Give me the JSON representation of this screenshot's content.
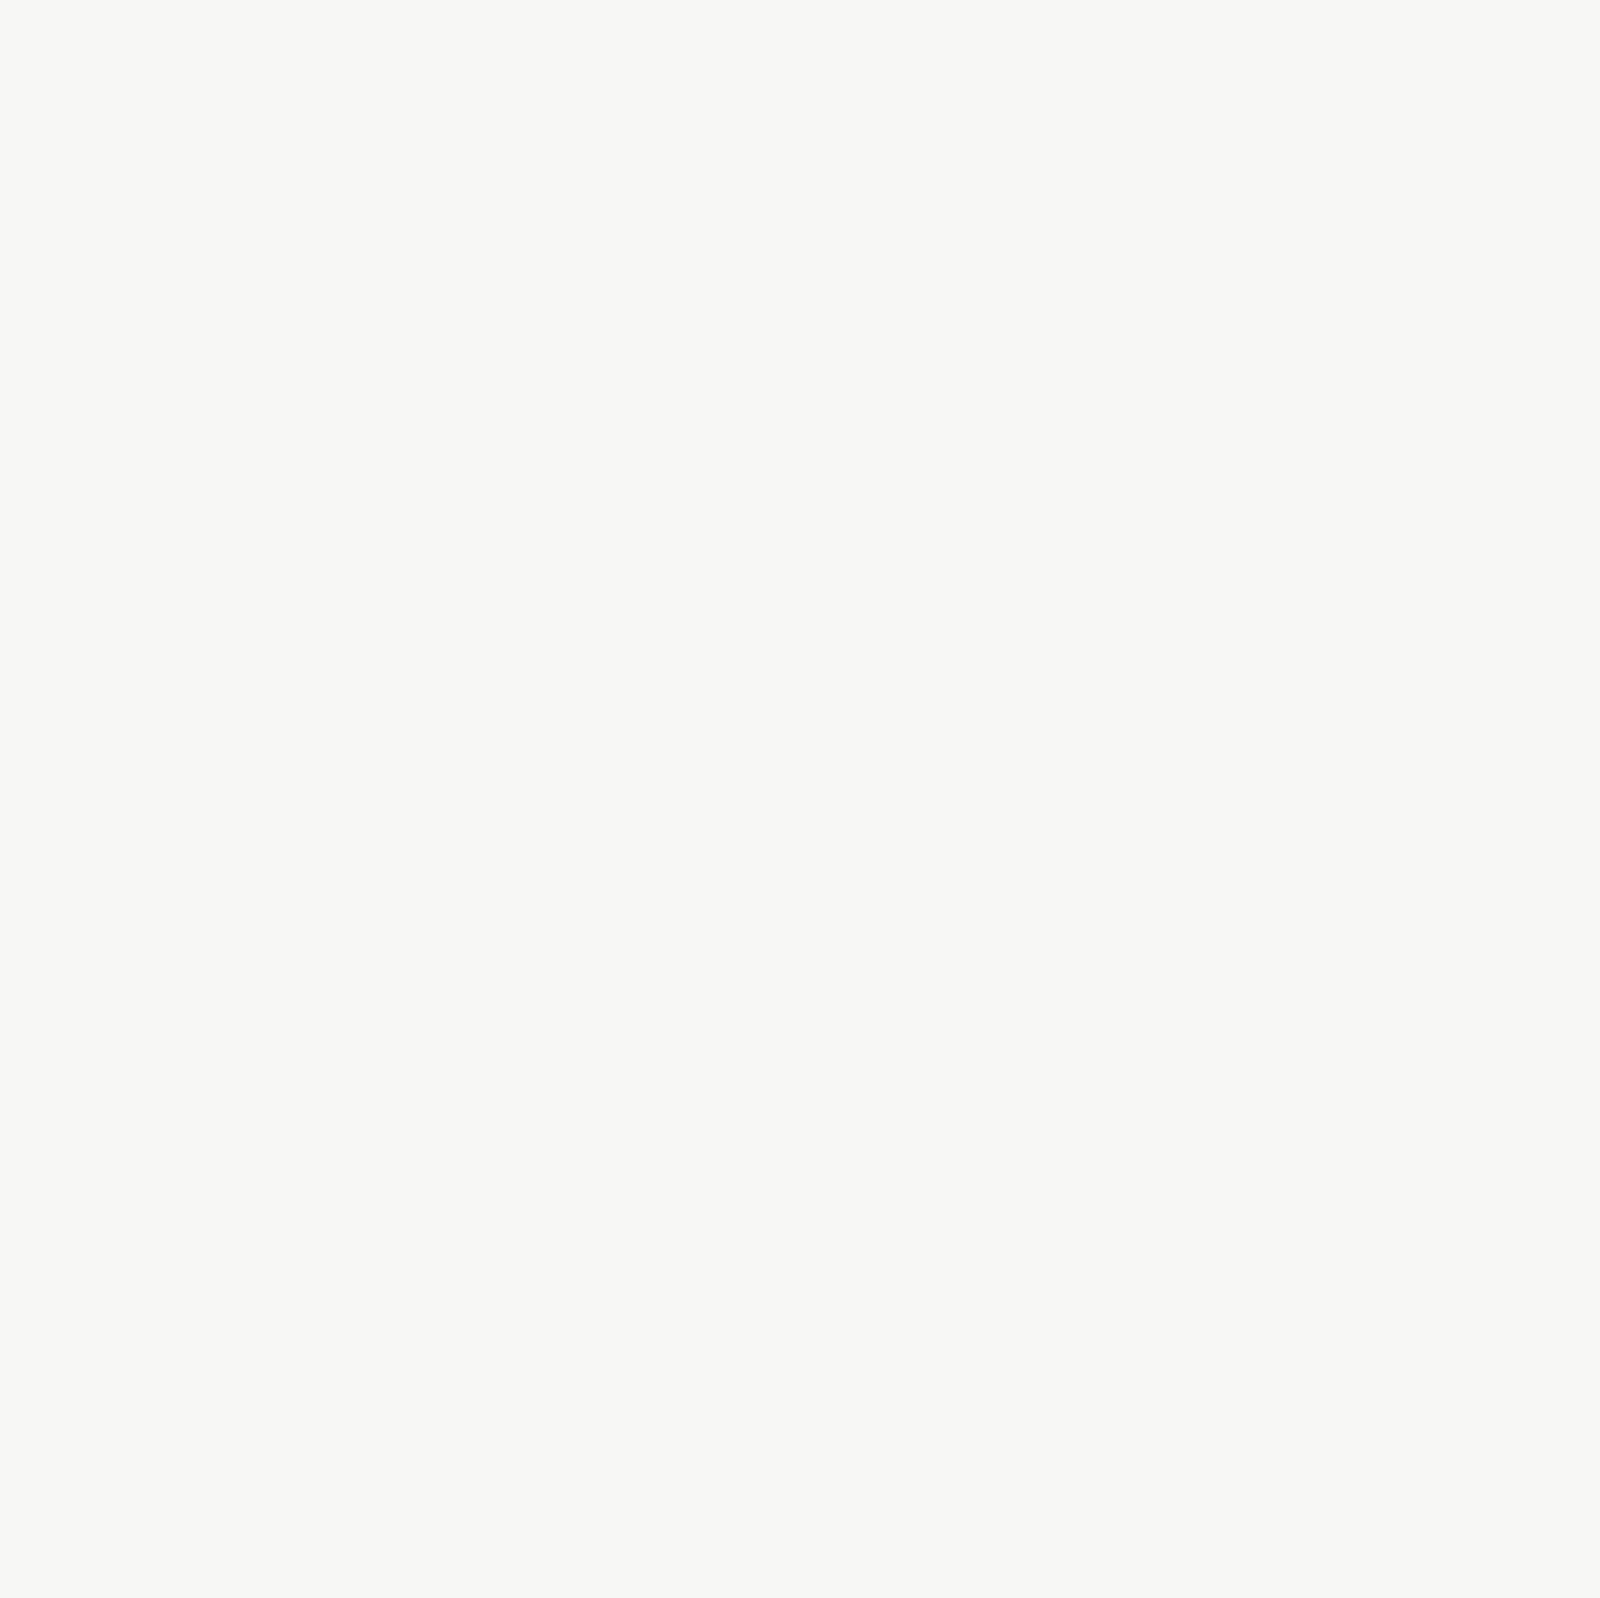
{
  "map": {
    "title_area": "Les Jardins Neppert - plan masse",
    "lots": {
      "n4": {
        "title": "Lot N4",
        "subtitle": "LOT N4 - 12 LOGTS",
        "note_line1": "21 pl. par nx",
        "note_line2": "84 places sur 4 nx"
      },
      "n3": {
        "title": "Lot N3",
        "subtitle": "LOT N3 - 9 LOGTS",
        "parking": "12 pl."
      },
      "ch1": {
        "title": "Lot Ch1",
        "subtitle": "LOT CH1 - 8 LOGTS"
      },
      "ch2": {
        "title": "Lot Ch2",
        "subtitle": "LOT CH2 - 39 LOGTS",
        "parking": "62 pl."
      },
      "n7": {
        "title": "Lot N7",
        "subtitle": "LOT N7 - 55 LOGTS"
      },
      "n8": {
        "title": "Lot N8",
        "subtitle": "LOT N8 - 46 LOGTS",
        "parking_left": "29 pl.",
        "parking_right": "18 pl."
      },
      "ch4": {
        "title": "Lot Ch4",
        "subtitle": "LOT CH4 - 34 LOGTS",
        "parking_top": "15 pl.",
        "parking_vertical": "20 pl.",
        "parking_question": "26 pl.?"
      },
      "n9": {
        "title": "Lot N9",
        "subtitle": "LOT N9 - 45 LOGTS",
        "parking": "25 pl.",
        "note": "54 places sur 2 nx"
      },
      "ch_truncated": "Ch"
    },
    "zones": {
      "n2": "N2",
      "n5": "N5",
      "n6": "N6"
    },
    "heights": {
      "r3c": "R+3+c",
      "r2c_a": "R+2+c",
      "r2c_b": "R+2+c",
      "r2c_c": "R+2+c",
      "r4": "R+4",
      "r3": "R+3",
      "r1": "R+1",
      "rdcc": "RDC+c"
    },
    "streets": {
      "rue_des_roses": "Rue des Roses",
      "passage_des_roses": "Passage des Roses",
      "rue_neppert_west": "Rue Neppert",
      "rue_neppert_east": "Rue Neppert",
      "rue_de_la_branche": "Rue de la Branche",
      "rue_des_chaudronniers": "Rue des Chaudronniers",
      "rue_des_menuisiers": "Rue des Menuisiers",
      "rue_des_charpentiers_north": "Rue des Charpentiers",
      "impasse_des_charpentiers": "Impasse des Charpentiers",
      "rue_des_charpentiers_south": "Rue des Charpentiers",
      "rue_de_lyser": "Rue de l'Yser",
      "passage_des_vergers": "Passage des Vergers",
      "rue_des_vergers": "Rue des Vergers",
      "rue_des_pyrenees": "Rue des Pyrénées",
      "rue_d_ensisheim": "Rue d'Ensisheim",
      "rue_d_illzach": "Rue d' Illzach",
      "rue_du_capitaine_dreyfus": "Rue du Capitaine Dreyfus",
      "les_mesanges": "Les Mésanges"
    },
    "places": {
      "ecole": "ÉCOLE J. DE LOISY",
      "eglise_line1": "ÉGLISE",
      "eglise_line2": "BONNE NOUVELLE",
      "tabor_line1": "Eglise",
      "tabor_line2": "de Tabor",
      "somco_vertical": "SOMCO",
      "somco_horizontal": "SOMCO",
      "fjt": "FJT",
      "maison_line1": "Maison",
      "maison_line2": "conservée",
      "jardins_title": "LES JARDINS NEPPERT",
      "jardin2_line1": "JARDIN 2",
      "jardin2_line2": "8 635 m²",
      "jardin3_line1": "JARDIN 3",
      "jardin3_line2": "8 720 m²"
    },
    "colors": {
      "lot-boundary": "#e11a2b",
      "zone-boundary": "#8c3a46",
      "lot-title": "#9c1313",
      "parking-fill": "#a9c6d8",
      "parking-fill-dark": "#3f7090",
      "parking-tick": "#55809c",
      "building-red": "#f0837e",
      "building-pink": "#f7c6c9",
      "building-orange": "#f8bd74",
      "building-cream": "#f0ebc0",
      "path-blue": "#1d5d8c",
      "park-green": "#cbd4ae",
      "park-light": "#e3e7d1",
      "band-olive": "#8e9c64",
      "text-dark": "#333333",
      "label-navy": "#1d4f7c",
      "parking-label": "#16405e"
    }
  }
}
